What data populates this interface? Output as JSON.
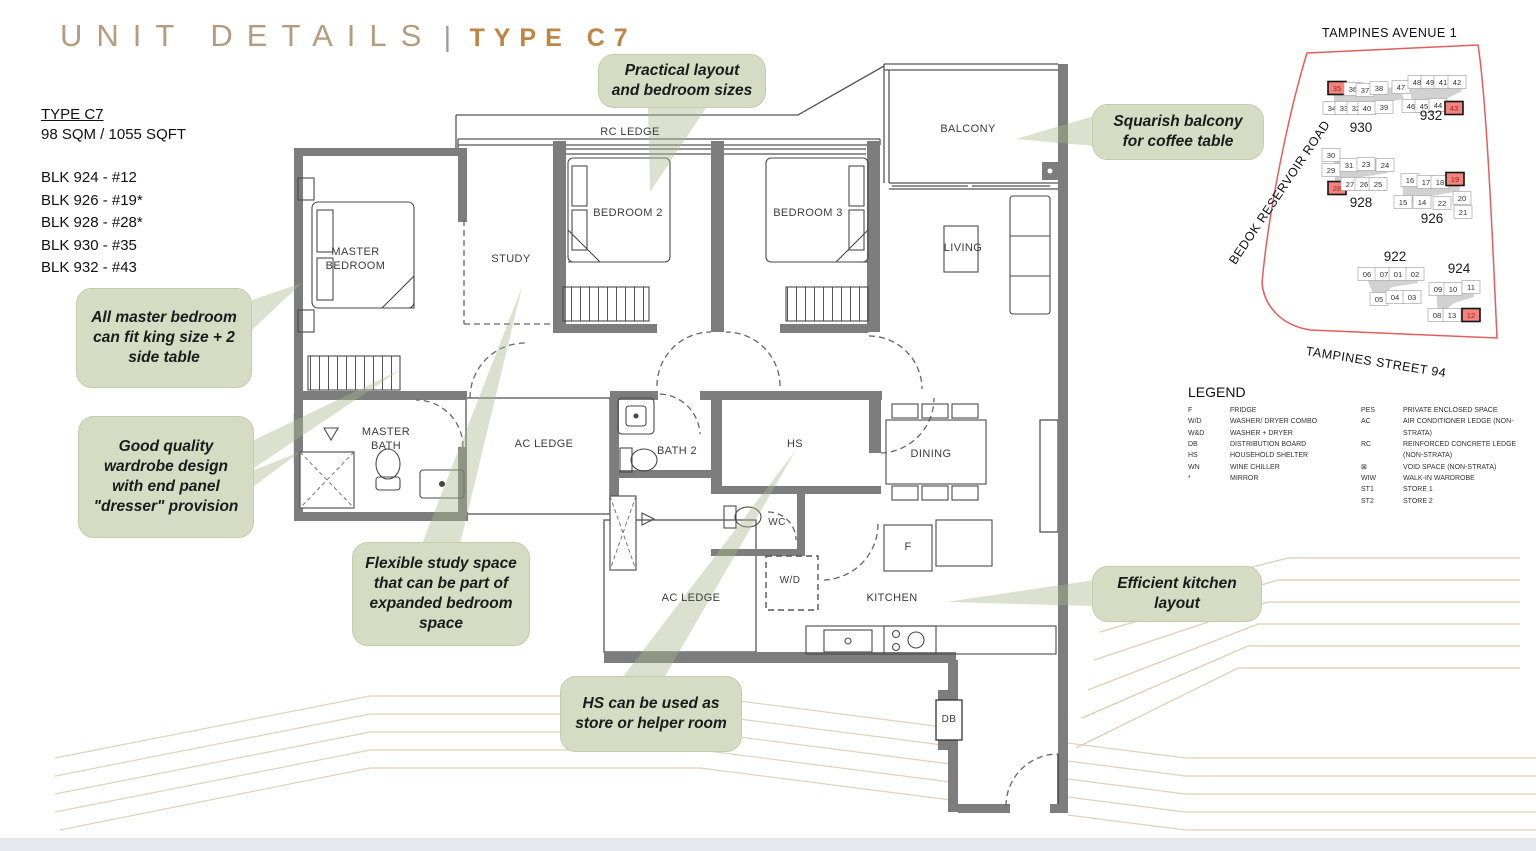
{
  "header": {
    "title_left": "UNIT DETAILS",
    "separator": "|",
    "title_right": "TYPE C7"
  },
  "unit_info": {
    "type_label": "TYPE C7",
    "area": "98 SQM / 1055 SQFT",
    "blocks": [
      "BLK 924 - #12",
      "BLK 926 - #19*",
      "BLK 928 - #28*",
      "BLK 930 - #35",
      "BLK 932 - #43"
    ]
  },
  "floorplan": {
    "labels": {
      "rc_ledge": "RC LEDGE",
      "master_bedroom": "MASTER BEDROOM",
      "study": "STUDY",
      "bedroom2": "BEDROOM 2",
      "bedroom3": "BEDROOM 3",
      "balcony": "BALCONY",
      "living": "LIVING",
      "master_bath": "MASTER BATH",
      "ac_ledge_mid": "AC LEDGE",
      "bath2": "BATH 2",
      "hs": "HS",
      "dining": "DINING",
      "wc": "WC",
      "wd": "W/D",
      "ac_ledge_bottom": "AC LEDGE",
      "kitchen": "KITCHEN",
      "fridge": "F",
      "db": "DB"
    }
  },
  "callouts": {
    "practical": "Practical layout and bedroom sizes",
    "balcony": "Squarish balcony for coffee table",
    "master": "All master bedroom can fit king size + 2 side table",
    "wardrobe": "Good quality wardrobe design with end panel \"dresser\" provision",
    "study": "Flexible study space that can be part of expanded bedroom space",
    "hs": "HS can be used as store or helper room",
    "kitchen": "Efficient kitchen layout"
  },
  "sitemap": {
    "roads": {
      "top": "TAMPINES AVENUE 1",
      "left": "BEDOK RESERVOIR ROAD",
      "bottom": "TAMPINES STREET 94"
    },
    "highlight_color": "#f2837d",
    "boundary_color": "#e35d5d",
    "blocks": [
      {
        "label": "930",
        "lx": 111,
        "ly": 107,
        "units": [
          [
            "35",
            87,
            63,
            1
          ],
          [
            "36",
            103,
            64,
            0
          ],
          [
            "37",
            115,
            65,
            0
          ],
          [
            "38",
            129,
            63,
            0
          ],
          [
            "47",
            151,
            62,
            0
          ],
          [
            "34",
            82,
            83,
            0
          ],
          [
            "33",
            94,
            83,
            0
          ],
          [
            "32",
            106,
            83,
            0
          ],
          [
            "40",
            117,
            83,
            0
          ],
          [
            "39",
            134,
            82,
            0
          ]
        ]
      },
      {
        "label": "932",
        "lx": 181,
        "ly": 95,
        "units": [
          [
            "48",
            167,
            57,
            0
          ],
          [
            "49",
            180,
            57,
            0
          ],
          [
            "41",
            193,
            57,
            0
          ],
          [
            "42",
            207,
            57,
            0
          ],
          [
            "46",
            161,
            81,
            0
          ],
          [
            "45",
            174,
            81,
            0
          ],
          [
            "44",
            188,
            80,
            0
          ],
          [
            "43",
            204,
            83,
            1
          ]
        ]
      },
      {
        "label": "928",
        "lx": 111,
        "ly": 182,
        "units": [
          [
            "30",
            81,
            130,
            0
          ],
          [
            "29",
            81,
            145,
            0
          ],
          [
            "31",
            99,
            140,
            0
          ],
          [
            "23",
            116,
            139,
            0
          ],
          [
            "24",
            135,
            140,
            0
          ],
          [
            "28",
            87,
            163,
            1
          ],
          [
            "27",
            100,
            159,
            0
          ],
          [
            "26",
            114,
            159,
            0
          ],
          [
            "25",
            128,
            159,
            0
          ]
        ]
      },
      {
        "label": "926",
        "lx": 182,
        "ly": 198,
        "units": [
          [
            "16",
            160,
            155,
            0
          ],
          [
            "17",
            176,
            157,
            0
          ],
          [
            "18",
            190,
            157,
            0
          ],
          [
            "19",
            205,
            154,
            1
          ],
          [
            "15",
            153,
            177,
            0
          ],
          [
            "14",
            172,
            177,
            0
          ],
          [
            "22",
            192,
            178,
            0
          ],
          [
            "20",
            212,
            173,
            0
          ],
          [
            "21",
            213,
            187,
            0
          ]
        ]
      },
      {
        "label": "922",
        "lx": 145,
        "ly": 236,
        "units": [
          [
            "06",
            117,
            249,
            0
          ],
          [
            "07",
            134,
            249,
            0
          ],
          [
            "01",
            148,
            249,
            0
          ],
          [
            "02",
            165,
            249,
            0
          ],
          [
            "05",
            129,
            274,
            0
          ],
          [
            "04",
            145,
            272,
            0
          ],
          [
            "03",
            162,
            272,
            0
          ]
        ]
      },
      {
        "label": "924",
        "lx": 209,
        "ly": 248,
        "units": [
          [
            "09",
            188,
            264,
            0
          ],
          [
            "10",
            203,
            264,
            0
          ],
          [
            "11",
            221,
            262,
            0
          ],
          [
            "08",
            187,
            290,
            0
          ],
          [
            "13",
            202,
            290,
            0
          ],
          [
            "12",
            221,
            290,
            1
          ]
        ]
      }
    ]
  },
  "legend": {
    "title": "LEGEND",
    "left": [
      {
        "key": "F",
        "desc": "FRIDGE"
      },
      {
        "key": "W/D",
        "desc": "WASHER/ DRYER COMBO"
      },
      {
        "key": "W&D",
        "desc": "WASHER + DRYER"
      },
      {
        "key": "DB",
        "desc": "DISTRIBUTION BOARD"
      },
      {
        "key": "HS",
        "desc": "HOUSEHOLD SHELTER"
      },
      {
        "key": "WN",
        "desc": "WINE CHILLER"
      },
      {
        "key": "*",
        "desc": "MIRROR"
      }
    ],
    "right": [
      {
        "key": "PES",
        "desc": "PRIVATE ENCLOSED SPACE"
      },
      {
        "key": "AC",
        "desc": "AIR CONDITIONER LEDGE (NON-STRATA)"
      },
      {
        "key": "RC",
        "desc": "REINFORCED CONCRETE LEDGE (NON-STRATA)"
      },
      {
        "key": "⊠",
        "desc": "VOID SPACE (NON-STRATA)"
      },
      {
        "key": "WIW",
        "desc": "WALK-IN WARDROBE"
      },
      {
        "key": "ST1",
        "desc": "STORE 1"
      },
      {
        "key": "ST2",
        "desc": "STORE 2"
      }
    ]
  },
  "colors": {
    "title_left": "#b59c81",
    "title_right": "#bf8546",
    "wall": "#7d7d7d",
    "callout_bg": "#d5dcc3",
    "decor_line": "#d8c6ab"
  }
}
